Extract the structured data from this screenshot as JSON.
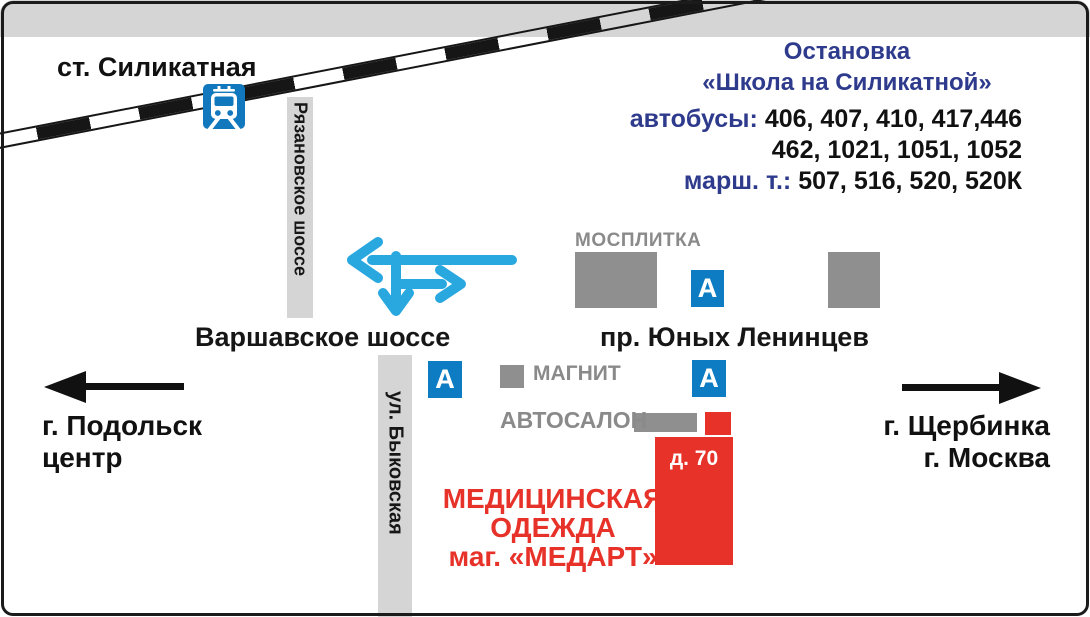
{
  "station": {
    "label": "ст. Силикатная"
  },
  "roads": {
    "ryazanovskoe_label": "Рязановское шоссе",
    "varshavskoe_label": "Варшавское шоссе",
    "yunykh_lenintsev_label": "пр. Юных Ленинцев",
    "bykovskaya_label": "ул. Быковская"
  },
  "bus_stop_info": {
    "title_line1": "Остановка",
    "title_line2": "«Школа на Силикатной»",
    "buses_label": "автобусы:",
    "buses_numbers_line1": "406, 407, 410, 417,446",
    "buses_numbers_line2": "462, 1021, 1051, 1052",
    "route_taxi_label": "марш. т.:",
    "route_taxi_numbers": "507, 516, 520, 520К"
  },
  "directions": {
    "west_line1": "г. Подольск",
    "west_line2": "центр",
    "east_line1": "г. Щербинка",
    "east_line2": "г. Москва"
  },
  "landmarks": {
    "mosplitka_label": "МОСПЛИТКА",
    "magnit_label": "МАГНИТ",
    "avtosalon_label": "АВТОСАЛОН",
    "building_number": "д. 70"
  },
  "destination": {
    "line1": "МЕДИЦИНСКАЯ",
    "line2": "ОДЕЖДА",
    "line3": "маг. «МЕДАРТ»"
  },
  "icons": {
    "bus_stop_letter": "А"
  },
  "colors": {
    "navy_text": "#2e3a8c",
    "sign_blue": "#0e7cc2",
    "route_arrow_blue": "#29a8e0",
    "accent_red": "#e73229",
    "road_gray": "#d5d5d5",
    "building_gray": "#8f8f8f",
    "label_gray": "#8a8a8a"
  }
}
